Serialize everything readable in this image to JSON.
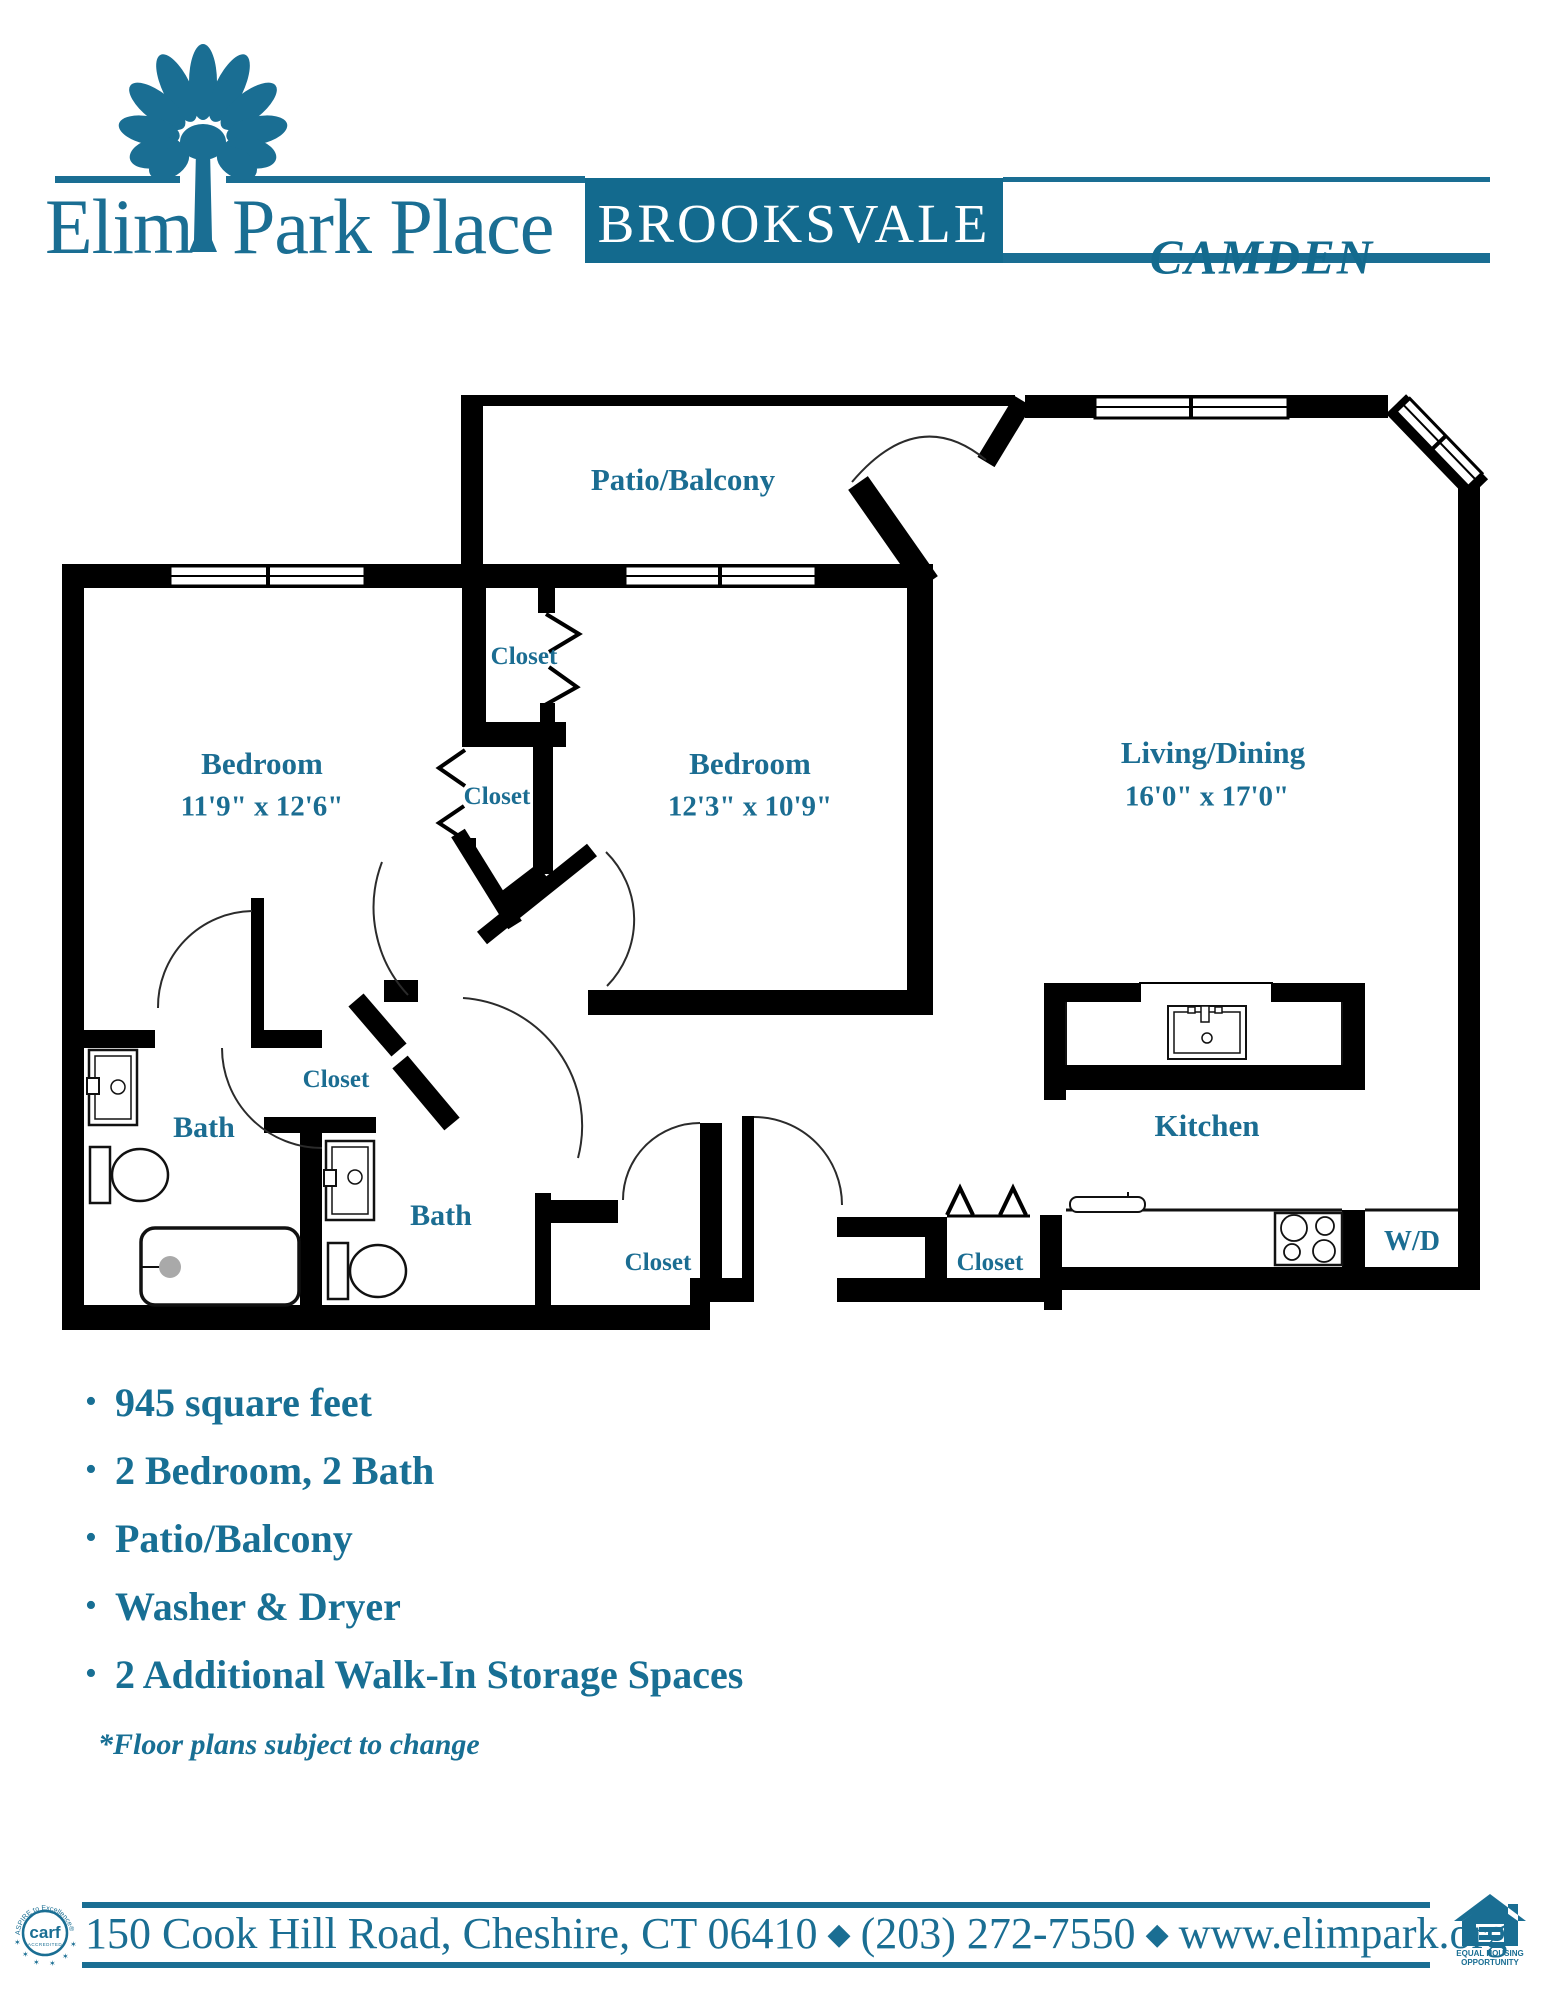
{
  "header": {
    "brand_left": "Elim",
    "brand_right": "Park Place",
    "building": "BROOKSVALE",
    "unit": "CAMDEN"
  },
  "floorplan": {
    "closet_label": "Closet",
    "patio": "Patio/Balcony",
    "bedroom1": {
      "name": "Bedroom",
      "dims": "11'9\" x 12'6\""
    },
    "bedroom2": {
      "name": "Bedroom",
      "dims": "12'3\" x 10'9\""
    },
    "living": {
      "name": "Living/Dining",
      "dims": "16'0\" x 17'0\""
    },
    "bath1": "Bath",
    "bath2": "Bath",
    "kitchen": "Kitchen",
    "wd": "W/D"
  },
  "features": {
    "items": [
      "945 square feet",
      "2 Bedroom, 2 Bath",
      "Patio/Balcony",
      "Washer & Dryer",
      "2 Additional Walk-In Storage Spaces"
    ]
  },
  "disclaimer": "*Floor plans subject to change",
  "footer": {
    "address": "150 Cook Hill Road, Cheshire, CT 06410",
    "phone": "(203) 272-7550",
    "website": "www.elimpark.org",
    "separator": "◆",
    "carf": {
      "name": "carf",
      "accredited": "ACCREDITED",
      "tagline": "ASPIRE to Excellence®"
    },
    "eho": {
      "line1": "EQUAL HOUSING",
      "line2": "OPPORTUNITY"
    }
  },
  "colors": {
    "teal": "#1a6e93",
    "box_teal": "#136a8e",
    "wall": "#000000"
  }
}
